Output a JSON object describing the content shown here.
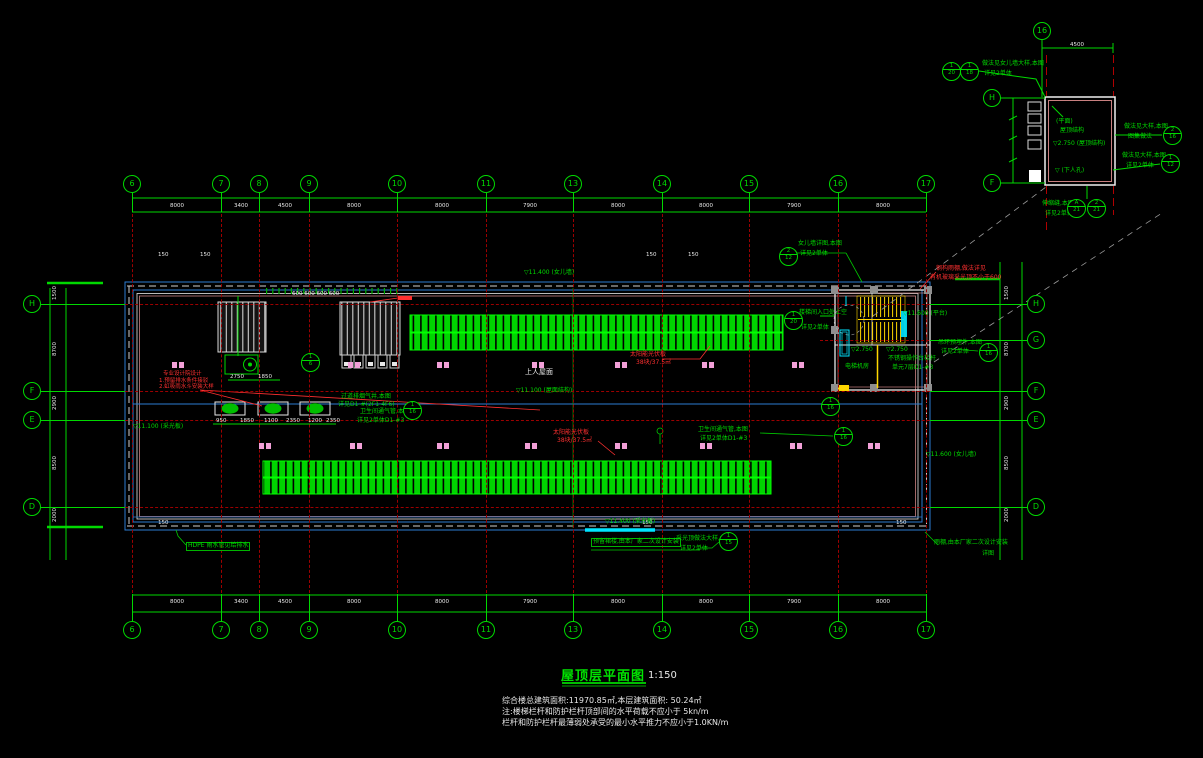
{
  "drawing": {
    "title": "屋顶层平面图",
    "scale": "1:150",
    "notes": [
      "综合楼总建筑面积:11970.85㎡,本层建筑面积: 50.24㎡",
      "注:楼梯栏杆和防护栏杆顶部间的水平荷载不应小于 5kn/m",
      "栏杆和防护栏杆最薄弱处承受的最小水平推力不应小于1.0KN/m"
    ]
  },
  "colors": {
    "green": "#00d900",
    "red": "#ff3030",
    "white": "#e8e8e8",
    "cyan": "#00e5ff",
    "grid_red": "#9c0000",
    "blue": "#2d7dd2",
    "yellow": "#ffd700",
    "pink": "#f2a0d8"
  },
  "axes": {
    "top": {
      "y": 184,
      "bubbles": [
        {
          "l": "6",
          "x": 132
        },
        {
          "l": "7",
          "x": 221
        },
        {
          "l": "8",
          "x": 259
        },
        {
          "l": "9",
          "x": 309
        },
        {
          "l": "10",
          "x": 397
        },
        {
          "l": "11",
          "x": 486
        },
        {
          "l": "13",
          "x": 573
        },
        {
          "l": "14",
          "x": 662
        },
        {
          "l": "15",
          "x": 749
        },
        {
          "l": "16",
          "x": 838
        },
        {
          "l": "17",
          "x": 926
        }
      ]
    },
    "bottom": {
      "y": 630,
      "bubbles": [
        {
          "l": "6",
          "x": 132
        },
        {
          "l": "7",
          "x": 221
        },
        {
          "l": "8",
          "x": 259
        },
        {
          "l": "9",
          "x": 309
        },
        {
          "l": "10",
          "x": 397
        },
        {
          "l": "11",
          "x": 486
        },
        {
          "l": "13",
          "x": 573
        },
        {
          "l": "14",
          "x": 662
        },
        {
          "l": "15",
          "x": 749
        },
        {
          "l": "16",
          "x": 838
        },
        {
          "l": "17",
          "x": 926
        }
      ]
    },
    "left": {
      "x": 32,
      "bubbles": [
        {
          "l": "H",
          "y": 304
        },
        {
          "l": "F",
          "y": 391
        },
        {
          "l": "E",
          "y": 420
        },
        {
          "l": "D",
          "y": 507
        }
      ]
    },
    "right": {
      "x": 1036,
      "bubbles": [
        {
          "l": "H",
          "y": 304
        },
        {
          "l": "G",
          "y": 340
        },
        {
          "l": "F",
          "y": 391
        },
        {
          "l": "E",
          "y": 420
        },
        {
          "l": "D",
          "y": 507
        }
      ]
    },
    "detail": {
      "bubbles": [
        {
          "l": "16",
          "x": 1042,
          "y": 31
        },
        {
          "l": "H",
          "x": 992,
          "y": 98
        },
        {
          "l": "F",
          "x": 992,
          "y": 183
        }
      ]
    }
  },
  "dims": {
    "top": [
      {
        "t": "8000",
        "x": 170,
        "y": 203
      },
      {
        "t": "3400",
        "x": 234,
        "y": 203
      },
      {
        "t": "4500",
        "x": 278,
        "y": 203
      },
      {
        "t": "8000",
        "x": 347,
        "y": 203
      },
      {
        "t": "8000",
        "x": 435,
        "y": 203
      },
      {
        "t": "7900",
        "x": 523,
        "y": 203
      },
      {
        "t": "8000",
        "x": 611,
        "y": 203
      },
      {
        "t": "8000",
        "x": 699,
        "y": 203
      },
      {
        "t": "7900",
        "x": 787,
        "y": 203
      },
      {
        "t": "8000",
        "x": 876,
        "y": 203
      }
    ],
    "bottom": [
      {
        "t": "8000",
        "x": 170,
        "y": 599
      },
      {
        "t": "3400",
        "x": 234,
        "y": 599
      },
      {
        "t": "4500",
        "x": 278,
        "y": 599
      },
      {
        "t": "8000",
        "x": 347,
        "y": 599
      },
      {
        "t": "8000",
        "x": 435,
        "y": 599
      },
      {
        "t": "7900",
        "x": 523,
        "y": 599
      },
      {
        "t": "8000",
        "x": 611,
        "y": 599
      },
      {
        "t": "8000",
        "x": 699,
        "y": 599
      },
      {
        "t": "7900",
        "x": 787,
        "y": 599
      },
      {
        "t": "8000",
        "x": 876,
        "y": 599
      }
    ],
    "left": [
      {
        "t": "1500",
        "x": 52,
        "y": 300,
        "r": 1
      },
      {
        "t": "8700",
        "x": 52,
        "y": 356,
        "r": 1
      },
      {
        "t": "2900",
        "x": 52,
        "y": 410,
        "r": 1
      },
      {
        "t": "8500",
        "x": 52,
        "y": 470,
        "r": 1
      },
      {
        "t": "2000",
        "x": 52,
        "y": 522,
        "r": 1
      }
    ],
    "right": [
      {
        "t": "1500",
        "x": 1004,
        "y": 300,
        "r": 1
      },
      {
        "t": "8700",
        "x": 1004,
        "y": 356,
        "r": 1
      },
      {
        "t": "2900",
        "x": 1004,
        "y": 410,
        "r": 1
      },
      {
        "t": "8500",
        "x": 1004,
        "y": 470,
        "r": 1
      },
      {
        "t": "2000",
        "x": 1004,
        "y": 522,
        "r": 1
      }
    ],
    "misc": [
      {
        "t": "2750",
        "x": 230,
        "y": 374
      },
      {
        "t": "1850",
        "x": 258,
        "y": 374
      },
      {
        "t": "950",
        "x": 216,
        "y": 418
      },
      {
        "t": "1850",
        "x": 240,
        "y": 418
      },
      {
        "t": "1100",
        "x": 264,
        "y": 418
      },
      {
        "t": "2350",
        "x": 286,
        "y": 418
      },
      {
        "t": "1200",
        "x": 308,
        "y": 418
      },
      {
        "t": "2350",
        "x": 326,
        "y": 418
      },
      {
        "t": "4500",
        "x": 1070,
        "y": 42
      },
      {
        "t": "600 600 600 600",
        "x": 292,
        "y": 291
      },
      {
        "t": "150",
        "x": 158,
        "y": 252
      },
      {
        "t": "150",
        "x": 200,
        "y": 252
      },
      {
        "t": "150",
        "x": 646,
        "y": 252
      },
      {
        "t": "150",
        "x": 688,
        "y": 252
      },
      {
        "t": "150",
        "x": 158,
        "y": 520
      },
      {
        "t": "150",
        "x": 642,
        "y": 520
      },
      {
        "t": "150",
        "x": 896,
        "y": 520
      }
    ]
  },
  "annotations": [
    {
      "t": "女儿墙详图,本图",
      "x": 798,
      "y": 241
    },
    {
      "t": "详见2单体",
      "x": 800,
      "y": 251
    },
    {
      "t": "做法见女儿墙大样,本图",
      "x": 982,
      "y": 61
    },
    {
      "t": "详见2单体",
      "x": 984,
      "y": 71
    },
    {
      "t": "做法见大样,本图",
      "x": 1124,
      "y": 124
    },
    {
      "t": "图集做法",
      "x": 1128,
      "y": 134
    },
    {
      "t": "做法见大样,本图",
      "x": 1122,
      "y": 153
    },
    {
      "t": "详见2单体",
      "x": 1126,
      "y": 163
    },
    {
      "t": "伸缩缝,本图",
      "x": 1042,
      "y": 201
    },
    {
      "t": "详见2单体",
      "x": 1045,
      "y": 211
    },
    {
      "t": "(平面)",
      "x": 1056,
      "y": 119
    },
    {
      "t": "屋顶结构",
      "x": 1060,
      "y": 128
    },
    {
      "t": "▽2.750 (屋顶结构)",
      "x": 1053,
      "y": 141
    },
    {
      "t": "▽ (下人孔)",
      "x": 1055,
      "y": 168
    },
    {
      "t": "楼梯间入口处上空",
      "x": 799,
      "y": 310
    },
    {
      "t": "详见2单体",
      "x": 801,
      "y": 325
    },
    {
      "t": "电梯机房",
      "x": 845,
      "y": 364
    },
    {
      "t": "不锈钢操作台栏杆",
      "x": 888,
      "y": 356
    },
    {
      "t": "单元7层D1-#3",
      "x": 892,
      "y": 365
    },
    {
      "t": "▽2.750",
      "x": 851,
      "y": 347
    },
    {
      "t": "▽2.750",
      "x": 886,
      "y": 347
    },
    {
      "t": "▽11.600 (平台)",
      "x": 903,
      "y": 311
    },
    {
      "t": "吊环预埋件,本图",
      "x": 938,
      "y": 340
    },
    {
      "t": "详见2单体",
      "x": 941,
      "y": 349
    },
    {
      "t": "过道排烟气井,本图",
      "x": 341,
      "y": 394
    },
    {
      "t": "详见D1-#(2F1-4F6)",
      "x": 338,
      "y": 402
    },
    {
      "t": "卫生间通气管,本图",
      "x": 360,
      "y": 409
    },
    {
      "t": "详见2单体D1-#3",
      "x": 357,
      "y": 418
    },
    {
      "t": "卫生间通气管,本图",
      "x": 698,
      "y": 427
    },
    {
      "t": "详见2单体D1-#3",
      "x": 700,
      "y": 436
    },
    {
      "t": "HDPE 雨水管见给排水",
      "x": 186,
      "y": 542,
      "b": 1
    },
    {
      "t": "预留裙楼,由本厂家二次设计安装",
      "x": 591,
      "y": 538,
      "b": 1
    },
    {
      "t": "采光顶做法大样,本图",
      "x": 676,
      "y": 536
    },
    {
      "t": "详见2单体",
      "x": 680,
      "y": 546
    },
    {
      "t": "雨棚,由本厂家二次设计安装",
      "x": 934,
      "y": 540
    },
    {
      "t": "详图",
      "x": 982,
      "y": 551
    },
    {
      "t": "▽11.400 (女儿墙)",
      "x": 524,
      "y": 270
    },
    {
      "t": "▽11.100 (屋面结构)",
      "x": 516,
      "y": 388
    },
    {
      "t": "▽11.100 (采光板)",
      "x": 133,
      "y": 424
    },
    {
      "t": "▽11.400 (采光板)",
      "x": 605,
      "y": 519
    },
    {
      "t": "▽11.600 (女儿墙)",
      "x": 926,
      "y": 452
    },
    {
      "t": "上人屋面",
      "x": 525,
      "y": 369,
      "c": "w",
      "s": 7
    },
    {
      "t": "钢构雨棚,做法详见",
      "x": 936,
      "y": 266,
      "c": "r"
    },
    {
      "t": "有机玻璃采光顶不小于600",
      "x": 930,
      "y": 275,
      "c": "r"
    },
    {
      "t": "专业设计院设计",
      "x": 163,
      "y": 371,
      "c": "r",
      "s": 5.5
    },
    {
      "t": "1.预留排水条件接驳",
      "x": 159,
      "y": 378,
      "c": "r",
      "s": 5.5
    },
    {
      "t": "2.虹吸雨水斗安装大样",
      "x": 159,
      "y": 384,
      "c": "r",
      "s": 5.5
    },
    {
      "t": "太阳能光伏板",
      "x": 630,
      "y": 352,
      "c": "r"
    },
    {
      "t": "38块/37.5㎡",
      "x": 636,
      "y": 360,
      "c": "r"
    },
    {
      "t": "太阳能光伏板",
      "x": 553,
      "y": 430,
      "c": "r"
    },
    {
      "t": "38块/37.5㎡",
      "x": 557,
      "y": 438,
      "c": "r"
    }
  ],
  "detail_circles": [
    {
      "x": 951,
      "y": 71,
      "a": "1",
      "b": "20"
    },
    {
      "x": 969,
      "y": 71,
      "a": "1",
      "b": "18"
    },
    {
      "x": 1172,
      "y": 135,
      "a": "2",
      "b": "16"
    },
    {
      "x": 1170,
      "y": 163,
      "a": "1",
      "b": "12"
    },
    {
      "x": 1076,
      "y": 208,
      "a": "A",
      "b": "21"
    },
    {
      "x": 1096,
      "y": 208,
      "a": "2",
      "b": "21"
    },
    {
      "x": 788,
      "y": 256,
      "a": "2",
      "b": "12"
    },
    {
      "x": 793,
      "y": 320,
      "a": "1",
      "b": "20"
    },
    {
      "x": 412,
      "y": 410,
      "a": "1",
      "b": "16"
    },
    {
      "x": 843,
      "y": 436,
      "a": "1",
      "b": "16"
    },
    {
      "x": 728,
      "y": 541,
      "a": "1",
      "b": "15"
    },
    {
      "x": 830,
      "y": 406,
      "a": "1",
      "b": "16"
    },
    {
      "x": 310,
      "y": 362,
      "a": "1",
      "b": "6"
    },
    {
      "x": 988,
      "y": 352,
      "a": "1",
      "b": "16"
    }
  ],
  "pink_markers": [
    {
      "y": 362,
      "xs": [
        172,
        348,
        437,
        532,
        615,
        702,
        792
      ]
    },
    {
      "y": 443,
      "xs": [
        259,
        350,
        437,
        525,
        615,
        700,
        790,
        868
      ]
    }
  ]
}
